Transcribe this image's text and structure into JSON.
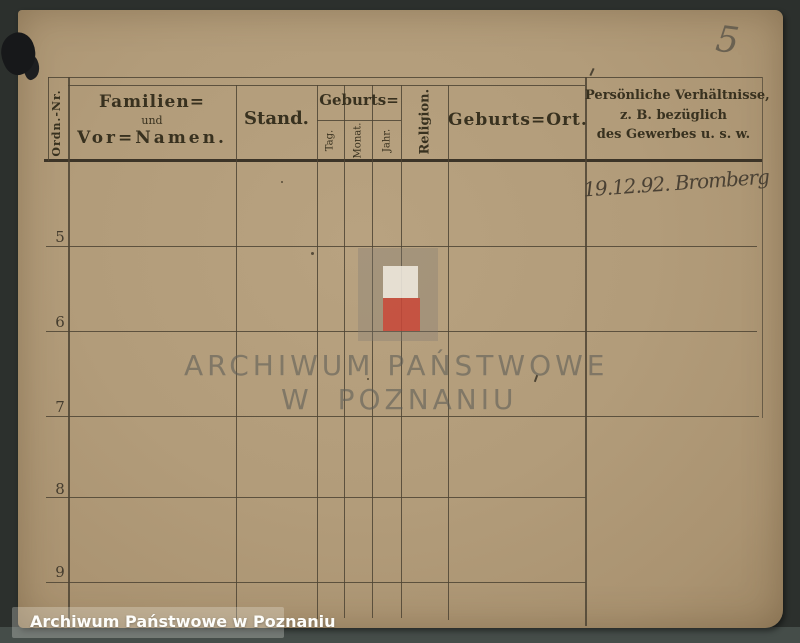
{
  "document": {
    "kind": "scanned archival register form",
    "language": "German (Fraktur print), Polish watermark"
  },
  "table": {
    "headers": {
      "ordn_nr": "Ordn.-Nr.",
      "familien_line1": "Familien=",
      "familien_line2": "und",
      "familien_line3": "Vor=Namen.",
      "stand": "Stand.",
      "geburts": "Geburts=",
      "tag": "Tag.",
      "monat": "Monat.",
      "jahr": "Jahr.",
      "religion": "Religion.",
      "geburts_ort": "Geburts=Ort.",
      "persoenliche_line1": "Persönliche Verhältnisse,",
      "persoenliche_line2": "z. B. bezüglich",
      "persoenliche_line3": "des Gewerbes u. s. w."
    },
    "row_numbers": [
      "5",
      "6",
      "7",
      "8",
      "9"
    ]
  },
  "handwriting": {
    "page_number": "5",
    "entry": "19.12.92. Bromberg"
  },
  "watermark": {
    "line1": "ARCHIWUM PAŃSTWOWE",
    "line2": "W POZNANIU",
    "flag_white": "rgba(242,236,226,0.85)",
    "flag_red": "rgba(205,68,52,0.8)",
    "panel_gray": "rgba(128,122,114,0.33)"
  },
  "footer": {
    "credit": "Archiwum Państwowe w Poznaniu"
  },
  "colors": {
    "paper": "#b29c7a",
    "background": "#2c302d",
    "grid_line": "#4d4434",
    "ink": "#38311f"
  }
}
